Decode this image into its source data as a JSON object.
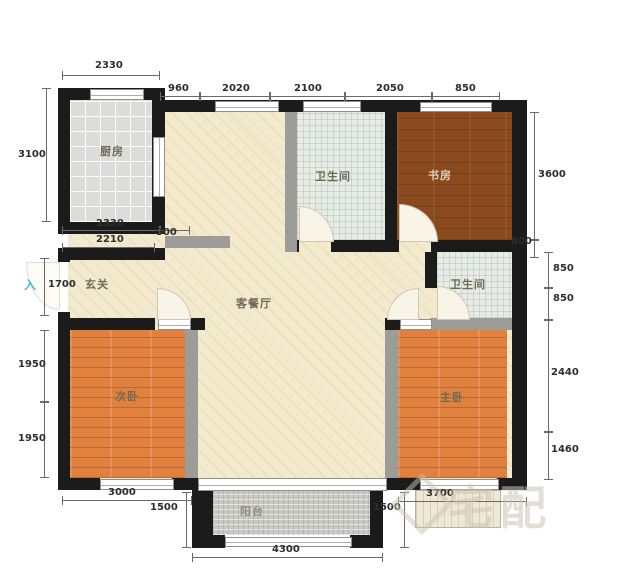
{
  "rooms": {
    "kitchen": {
      "label": "厨房"
    },
    "bath_top": {
      "label": "卫生间"
    },
    "study": {
      "label": "书房"
    },
    "foyer": {
      "label": "玄关"
    },
    "living_dining": {
      "label": "客餐厅"
    },
    "bath_right": {
      "label": "卫生间"
    },
    "bedroom_second": {
      "label": "次卧"
    },
    "bedroom_master": {
      "label": "主卧"
    },
    "balcony": {
      "label": "阳台"
    }
  },
  "entry_marker": "入",
  "watermark": {
    "text": "宅配",
    "logo": "house-diamond-logo"
  },
  "dimensions": {
    "top_2330": "2330",
    "top_960": "960",
    "top_2020": "2020",
    "top_2100": "2100",
    "top_2050": "2050",
    "top_850": "850",
    "left_3100": "3100",
    "left_1700": "1700",
    "left_1950_upper": "1950",
    "left_1950_lower": "1950",
    "kitchen_2330": "2330",
    "kitchen_900": "900",
    "kitchen_2210": "2210",
    "right_3600": "3600",
    "right_800": "800",
    "right_850_upper": "850",
    "right_850_lower": "850",
    "right_2440": "2440",
    "right_1460": "1460",
    "bottom_3000": "3000",
    "bottom_1500_left": "1500",
    "bottom_4300": "4300",
    "bottom_1500_right": "1500",
    "bottom_3700": "3700"
  },
  "colors": {
    "wall": "#1b1b1b",
    "wall_secondary": "#9c9c98",
    "living_floor": "#f3e9cd",
    "kitchen_floor": "#dcdcda",
    "bath_floor": "#e8ece7",
    "study_floor": "#8a4a1d",
    "bedroom_floor": "#e0813f",
    "balcony_floor": "#c9c9c4",
    "dimension_text": "#2e2e2e",
    "entry_arrow": "#49b6dc",
    "watermark": "#cdc4b2"
  }
}
